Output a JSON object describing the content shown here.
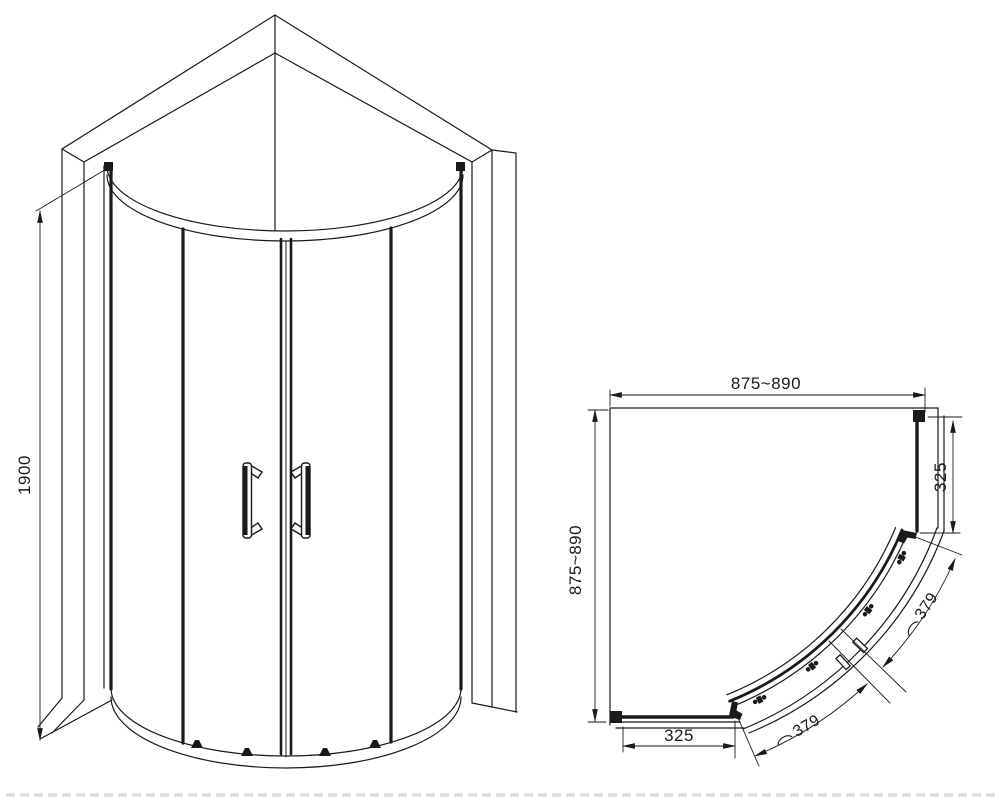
{
  "drawing_title": "quadrant-shower-enclosure-technical-drawing",
  "colors": {
    "line": "#1a1a1a",
    "background": "#ffffff"
  },
  "front_view": {
    "height": "1900"
  },
  "plan_view": {
    "width": "875~890",
    "depth": "875~890",
    "fixed_panel_right": "325",
    "fixed_panel_bottom": "325",
    "door_arc_right": "379",
    "door_arc_bottom": "379"
  }
}
